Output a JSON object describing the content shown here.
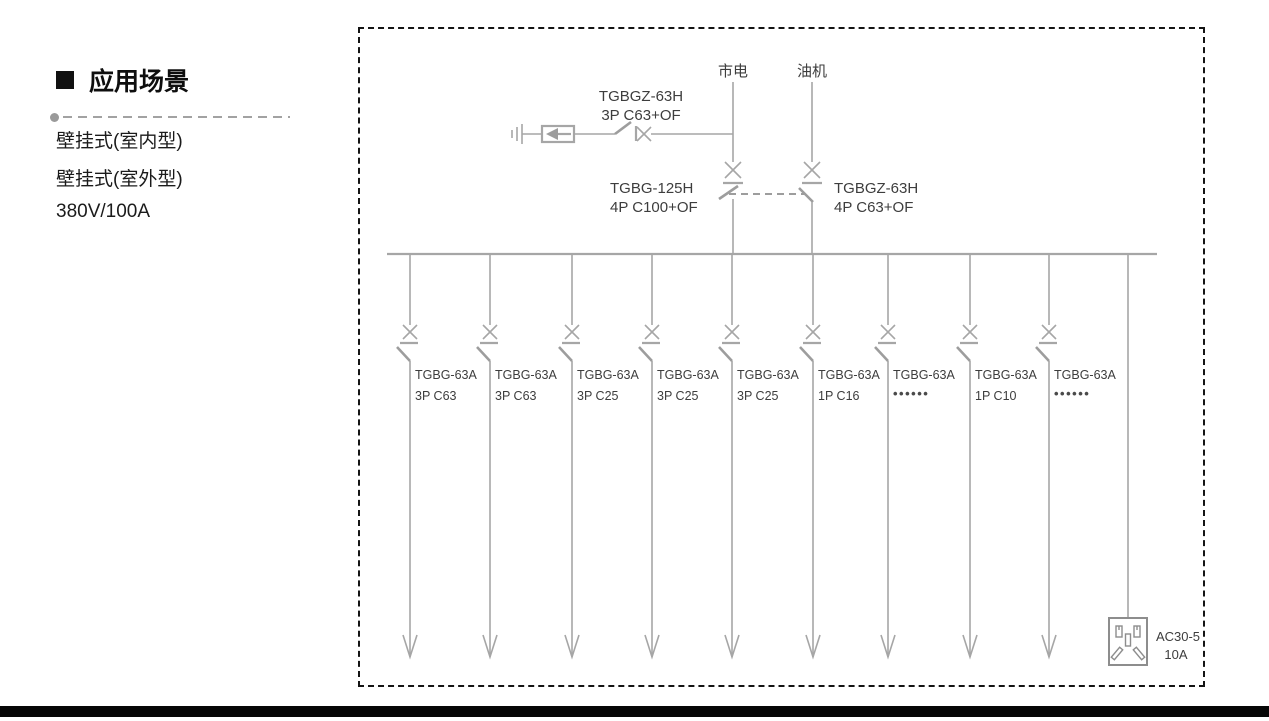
{
  "sidebar": {
    "section_title": "应用场景",
    "features": [
      "壁挂式(室内型)",
      "壁挂式(室外型)",
      "380V/100A"
    ]
  },
  "diagram": {
    "sources": [
      {
        "label": "市电"
      },
      {
        "label": "油机"
      }
    ],
    "spd_branch_breaker": {
      "model": "TGBGZ-63H",
      "spec": "3P C63+OF"
    },
    "mains_breaker": {
      "model": "TGBG-125H",
      "spec": "4P C100+OF"
    },
    "generator_breaker": {
      "model": "TGBGZ-63H",
      "spec": "4P C63+OF"
    },
    "branches": [
      {
        "model": "TGBG-63A",
        "spec": "3P C63"
      },
      {
        "model": "TGBG-63A",
        "spec": "3P C63"
      },
      {
        "model": "TGBG-63A",
        "spec": "3P C25"
      },
      {
        "model": "TGBG-63A",
        "spec": "3P C25"
      },
      {
        "model": "TGBG-63A",
        "spec": "3P C25"
      },
      {
        "model": "TGBG-63A",
        "spec": "1P C16"
      },
      {
        "model": "TGBG-63A",
        "spec": "••••••"
      },
      {
        "model": "TGBG-63A",
        "spec": "1P C10"
      },
      {
        "model": "TGBG-63A",
        "spec": "••••••"
      }
    ],
    "socket": {
      "model": "AC30-5",
      "rating": "10A"
    }
  },
  "colors": {
    "diagram_line": "#a6a6a6",
    "diagram_text": "#3d3d3d",
    "box_border": "#141414",
    "bottom_bar": "#060606"
  }
}
